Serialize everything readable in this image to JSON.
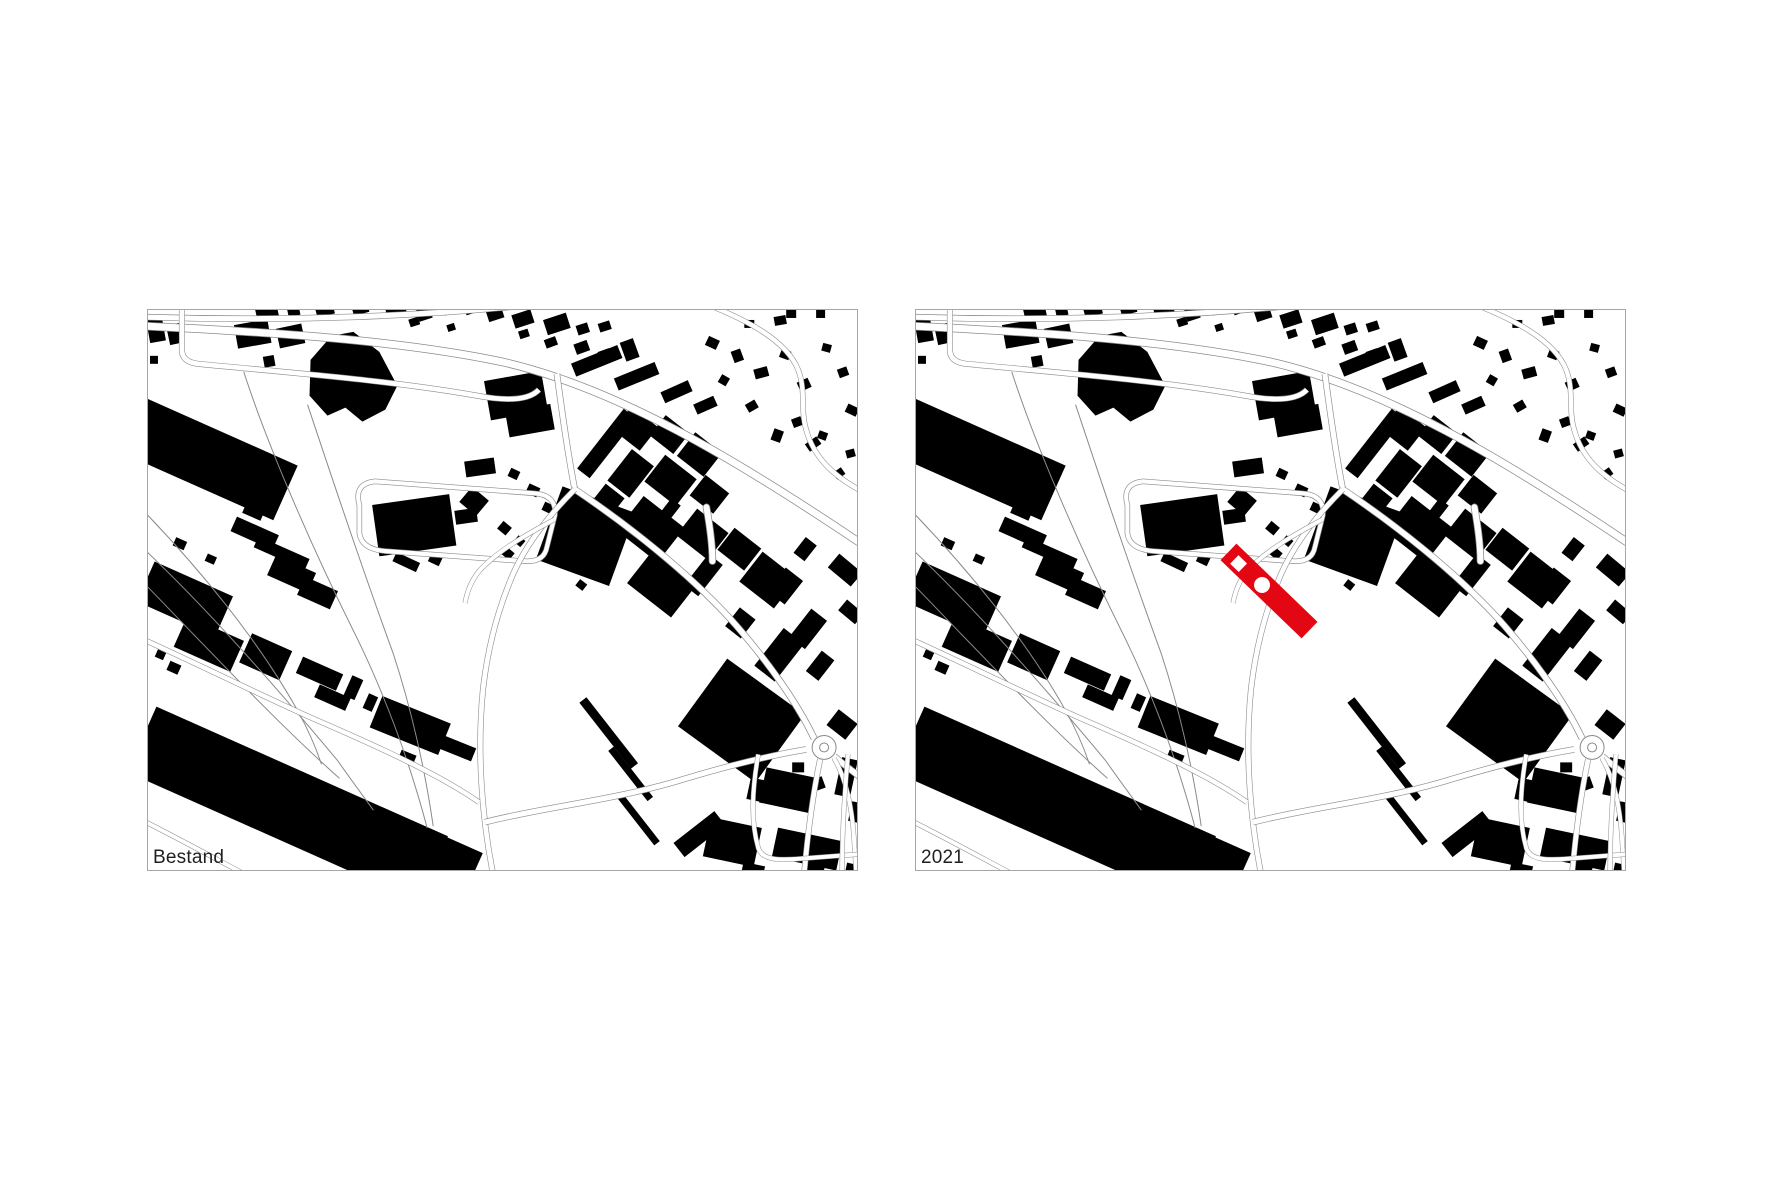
{
  "panels": [
    {
      "label": "Bestand"
    },
    {
      "label": "2021"
    }
  ],
  "colors": {
    "background": "#ffffff",
    "building": "#000000",
    "road_line": "#8a8a8a",
    "frame": "#a6a6a6",
    "highlight": "#e30613",
    "label_text": "#1f1f1f"
  }
}
